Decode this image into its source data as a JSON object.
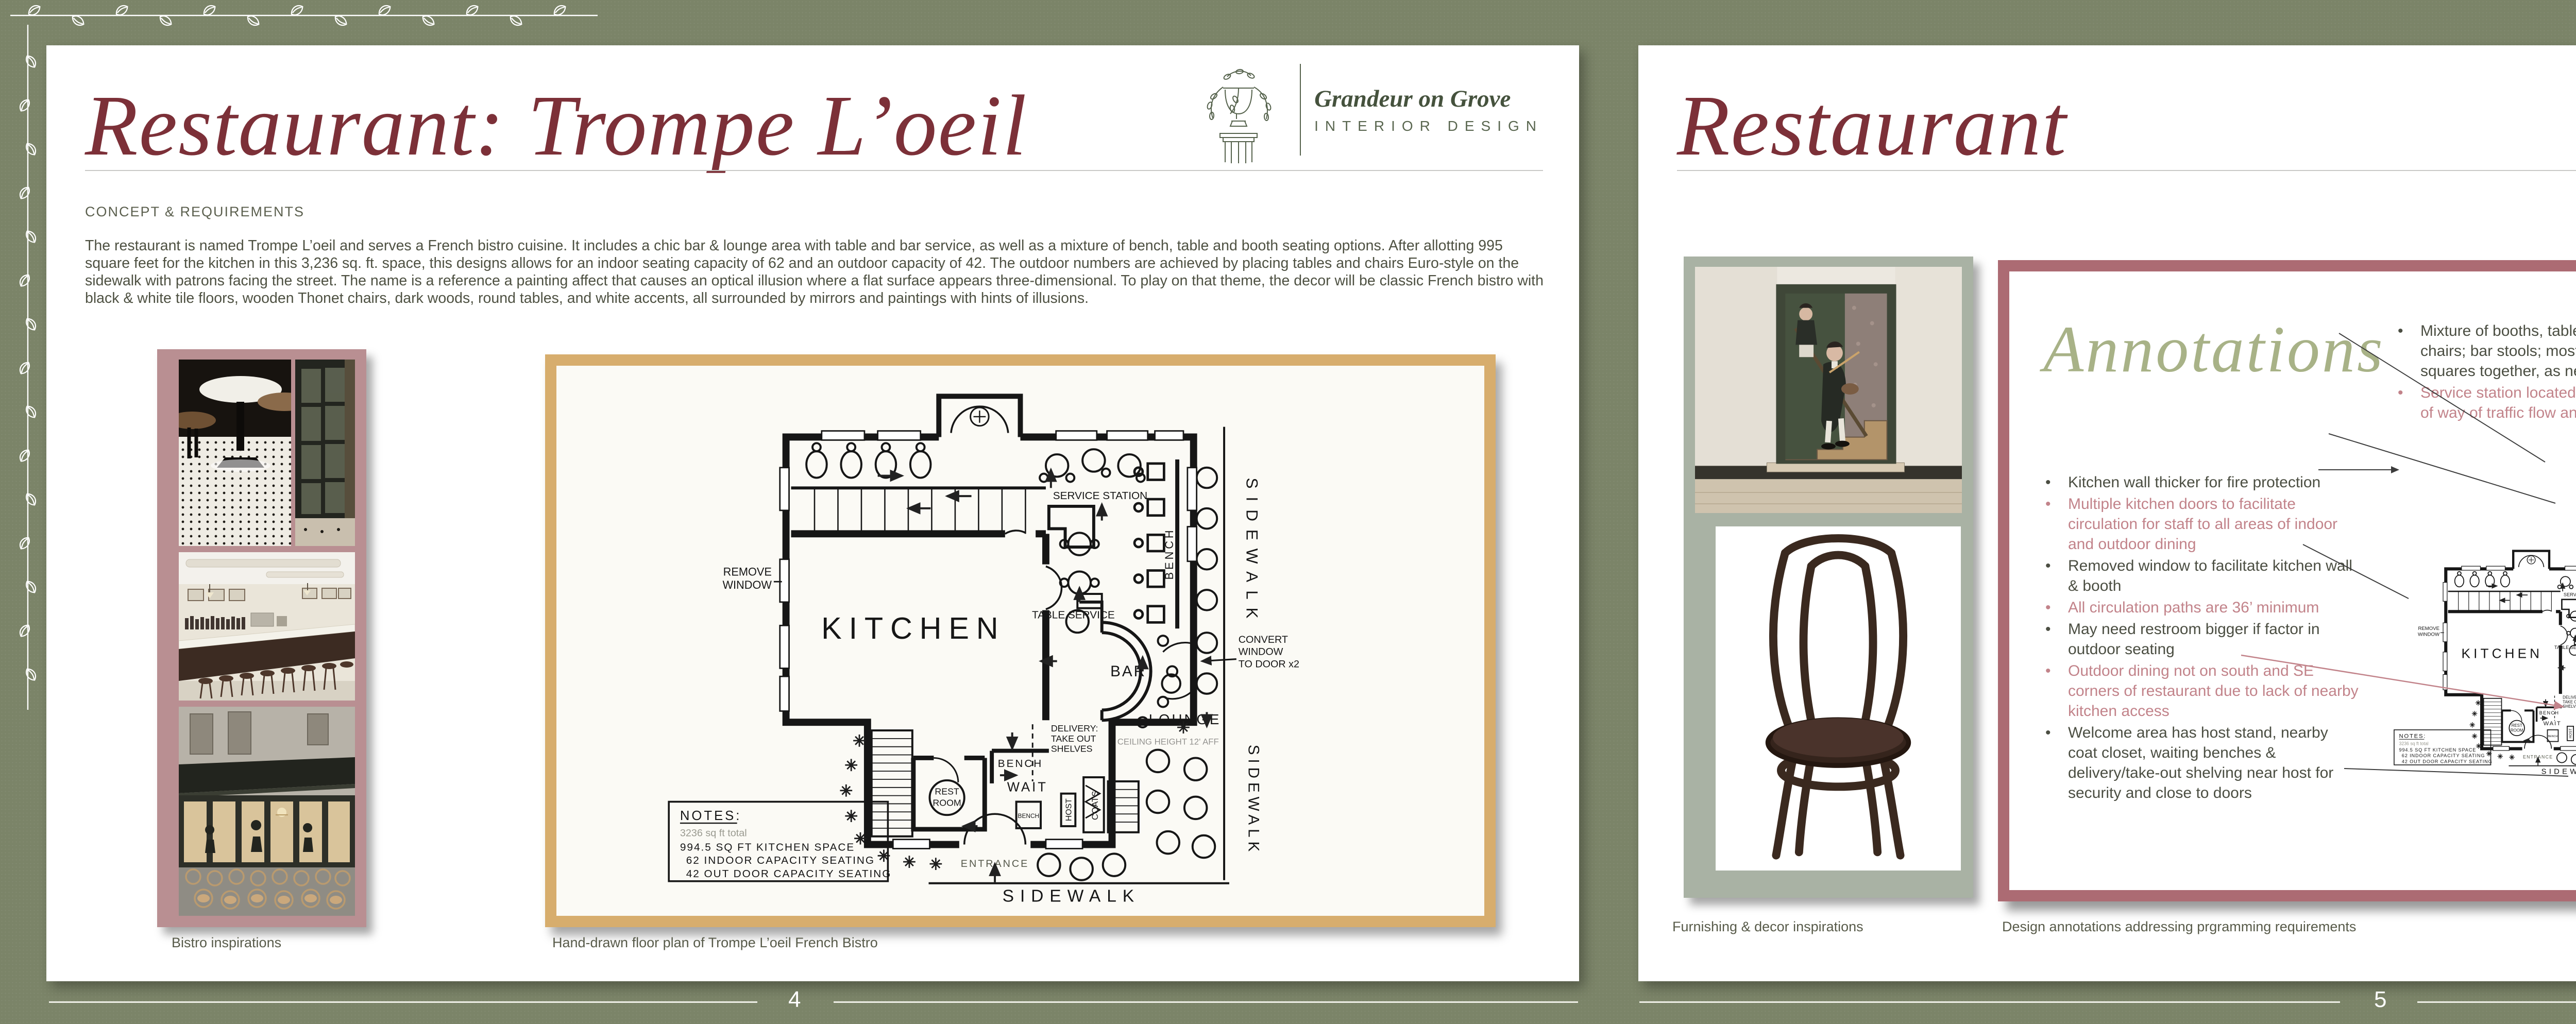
{
  "colors": {
    "background": "#7b8468",
    "maroon": "#7c3038",
    "olive_text": "#4e5142",
    "header_olive": "#5c604f",
    "pink": "#c2838a",
    "sage_script": "#a8b287",
    "panel_border": "#ac6b73",
    "photo_mat_mauve": "#b98f92",
    "plan_frame_tan": "#d7ad6d",
    "logo_green": "#55624c",
    "photo_mat_sage": "#a9b2a4",
    "footer_text": "#ffffff"
  },
  "logo": {
    "brand": "Grandeur on Grove",
    "subtitle": "INTERIOR DESIGN"
  },
  "left_page": {
    "title": "Restaurant: Trompe L’oeil",
    "section_header": "CONCEPT & REQUIREMENTS",
    "body_text": "The restaurant is named Trompe L’oeil and serves a French bistro cuisine. It includes a chic bar & lounge area with table and bar service, as well as a mixture of bench, table and booth seating options. After allotting 995 square feet for the kitchen in this 3,236 sq. ft. space, this designs allows for an indoor seating capacity of 62 and an outdoor capacity of 42. The outdoor numbers are achieved by placing tables and chairs Euro-style on the sidewalk with patrons facing the street. The name is a reference a painting affect that causes an optical illusion where a flat surface appears three-dimensional. To play on that theme, the decor will be classic French bistro with black & white tile floors, wooden Thonet chairs, dark woods, round tables, and white accents, all surrounded by mirrors and paintings with hints of illusions.",
    "caption_photos": "Bistro inspirations",
    "caption_plan": "Hand-drawn floor plan of Trompe L’oeil French Bistro",
    "page_number": "4"
  },
  "right_page": {
    "title": "Restaurant",
    "annotations_title": "Annotations",
    "brand_title": "Trompe L’oeil",
    "brand_subtitle": "French Bistro",
    "caption_photos": "Furnishing & decor inspirations",
    "caption_panel": "Design annotations addressing prgramming requirements",
    "page_number": "5",
    "left_bullets": [
      {
        "tone": "dark",
        "text": "Kitchen wall thicker for fire protection"
      },
      {
        "tone": "pink",
        "text": "Multiple kitchen doors to facilitate circulation for staff to all areas of indoor and outdoor dining"
      },
      {
        "tone": "dark",
        "text": "Removed window to facilitate kitchen wall & booth"
      },
      {
        "tone": "pink",
        "text": "All circulation paths are 36’ minimum"
      },
      {
        "tone": "dark",
        "text": "May need restroom bigger if factor in outdoor seating"
      },
      {
        "tone": "pink",
        "text": "Outdoor dining not on south and SE corners of restaurant due to lack of nearby kitchen access"
      },
      {
        "tone": "dark",
        "text": " Welcome area has host stand, nearby coat closet, waiting benches & delivery/take-out shelving near host for security and close to doors"
      }
    ],
    "middle_bullets": [
      {
        "tone": "dark",
        "text": "Mixture of booths, tables for 2 & 4, bench & chairs; bar stools; mostly round but push squares together, as needed"
      },
      {
        "tone": "pink",
        "text": "Service station located near kitchen, but out of way of traffic flow and dining"
      }
    ],
    "right_bullets": [
      {
        "tone": "dark",
        "text": "Outdoor dining maximizes seating options in 5’ area between restaurant and sidewalk; customers face the street euro-style for people watching"
      },
      {
        "tone": "pink",
        "text": "Replaced 2 windows with 2 doors for outdoor dining"
      },
      {
        "tone": "dark",
        "text": "Bar has area for table service pick-up for wait staff"
      },
      {
        "tone": "pink",
        "text": "Could swap in small outdoor service station with a plant, if needed"
      }
    ]
  },
  "floor_plan": {
    "kitchen": "KITCHEN",
    "bar": "BAR",
    "lounge": "LOUNGE",
    "service_station": "SERVICE STATION",
    "table_service": "TABLE SERVICE",
    "bench": "BENCH",
    "bench_small": "BENCH",
    "wait": "WAIT",
    "restroom_line1": "REST",
    "restroom_line2": "ROOM",
    "host": "HOST",
    "coats": "COATS",
    "entrance": "ENTRANCE",
    "sidewalk_right_top": "SIDEWALK",
    "sidewalk_right_bottom": "SIDEWALK",
    "sidewalk_bottom": "SIDEWALK",
    "remove_window_1": "REMOVE",
    "remove_window_2": "WINDOW",
    "convert_1": "CONVERT",
    "convert_2": "WINDOW",
    "convert_3": "TO DOOR x2",
    "delivery_1": "DELIVERY:",
    "delivery_2": "TAKE OUT",
    "delivery_3": "SHELVES",
    "ceiling": "CEILING HEIGHT 12' AFF",
    "notes_title": "NOTES:",
    "notes_1": "3236 sq ft total",
    "notes_2": "994.5 SQ FT KITCHEN SPACE",
    "notes_3": "62 INDOOR CAPACITY SEATING",
    "notes_4": "42 OUT DOOR CAPACITY SEATING"
  }
}
